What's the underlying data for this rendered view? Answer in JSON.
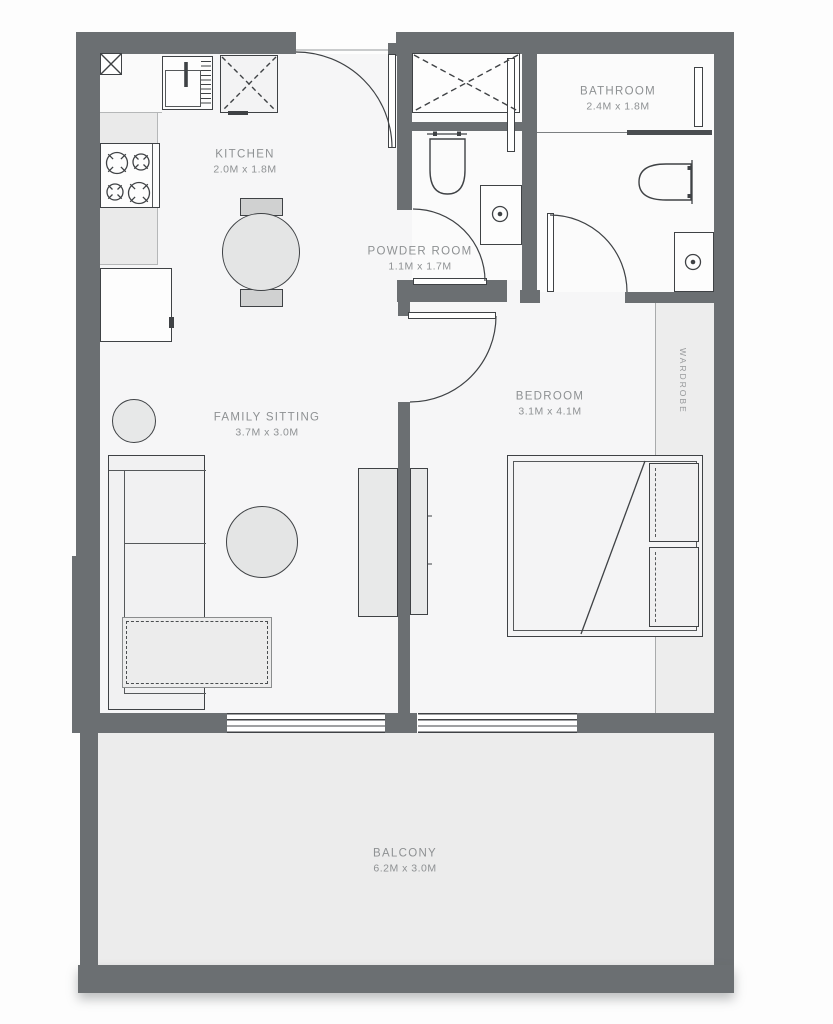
{
  "rooms": {
    "kitchen": {
      "label": "KITCHEN",
      "dims": "2.0M x 1.8M"
    },
    "powder_room": {
      "label": "POWDER ROOM",
      "dims": "1.1M x 1.7M"
    },
    "bathroom": {
      "label": "BATHROOM",
      "dims": "2.4M x 1.8M"
    },
    "family_sitting": {
      "label": "FAMILY SITTING",
      "dims": "3.7M x 3.0M"
    },
    "bedroom": {
      "label": "BEDROOM",
      "dims": "3.1M x 4.1M"
    },
    "wardrobe": {
      "label": "WARDROBE"
    },
    "balcony": {
      "label": "BALCONY",
      "dims": "6.2M x 3.0M"
    }
  },
  "colors": {
    "wall": "#6b6f72",
    "interior_floor": "#f6f6f7",
    "wet_room_floor": "#fbfbfb",
    "balcony_floor": "#ececec",
    "wardrobe_floor": "#ededed",
    "outline": "#3f4245",
    "label_text": "#8e9193"
  },
  "furniture_icons": [
    "entry-door-icon",
    "kitchen-sink-icon",
    "drainboard-icon",
    "refrigerator-icon",
    "stove-burners-icon",
    "washing-machine-icon",
    "dining-table-icon",
    "dining-seat-icon",
    "shower-tray-icon",
    "shower-glass-icon",
    "toilet-icon",
    "wash-basin-icon",
    "mirror-icon",
    "door-swing-icon",
    "sofa-icon",
    "side-table-icon",
    "coffee-table-icon",
    "rug-icon",
    "tv-unit-icon",
    "bed-icon",
    "pillow-icon",
    "sliding-window-icon",
    "column-icon"
  ]
}
